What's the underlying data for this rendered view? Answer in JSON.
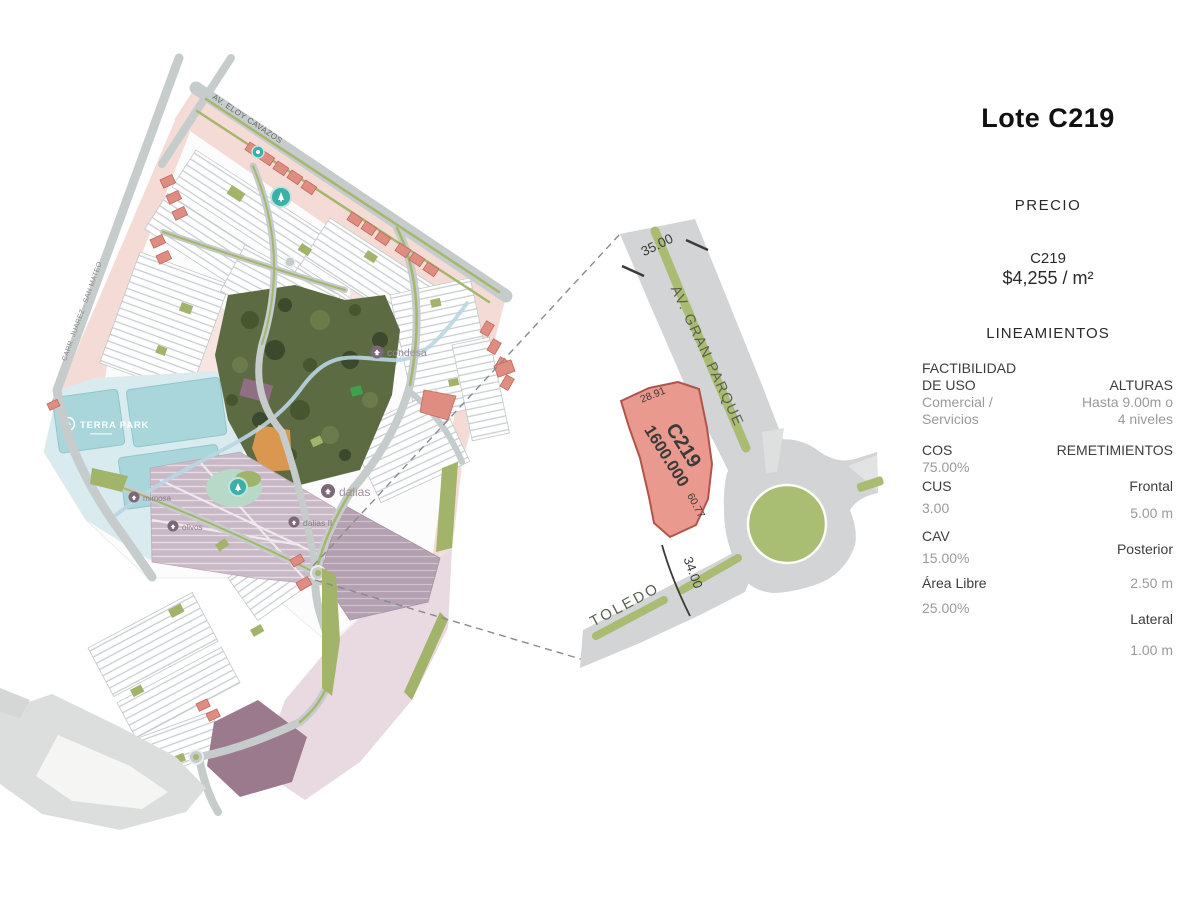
{
  "title": "Lote C219",
  "price_section": {
    "heading": "PRECIO",
    "lot": "C219",
    "price_per_m2": "$4,255 / m²"
  },
  "guidelines": {
    "heading": "LINEAMIENTOS",
    "factibilidad_label_1": "FACTIBILIDAD",
    "factibilidad_label_2": "DE USO",
    "factibilidad_value_1": "Comercial /",
    "factibilidad_value_2": "Servicios",
    "alturas_label": "ALTURAS",
    "alturas_value_1": "Hasta 9.00m o",
    "alturas_value_2": "4 niveles",
    "cos_label": "COS",
    "cos_value": "75.00%",
    "cus_label": "CUS",
    "cus_value": "3.00",
    "cav_label": "CAV",
    "cav_value": "15.00%",
    "area_libre_label": "Área Libre",
    "area_libre_value": "25.00%",
    "remetimientos_label": "REMETIMIENTOS",
    "frontal_label": "Frontal",
    "frontal_value": "5.00 m",
    "posterior_label": "Posterior",
    "posterior_value": "2.50 m",
    "lateral_label": "Lateral",
    "lateral_value": "1.00 m"
  },
  "lot_detail": {
    "street_main": "AV. GRAN PARQUE",
    "street_secondary": "TOLEDO",
    "lot_id": "C219",
    "lot_area": "1600.000",
    "dim_road_top": "35.00",
    "dim_road_bottom": "34.00",
    "dim_lot_top": "28.91",
    "dim_lot_side": "60.77"
  },
  "map": {
    "road_top": "AV. ELOY CAVAZOS",
    "road_left": "CARR. JUAREZ - SAN MATEO",
    "terra_park": "TERRA PARK",
    "labels": {
      "condesa": "condesa",
      "dalias": "dalias",
      "dalias2": "dalias II",
      "west1": "mimosa",
      "west2": "olivos"
    }
  },
  "colors": {
    "lot_fill": "#E9998D",
    "road_gray": "#D2D4D5",
    "median_green": "#A9BC72",
    "roundabout_green": "#A9BD73",
    "teal_badge": "#3CB0A6",
    "pink_zone": "#F5DBD5",
    "mauve_zone": "#CBBAC8",
    "maroon_zone": "#9B7A8D"
  }
}
